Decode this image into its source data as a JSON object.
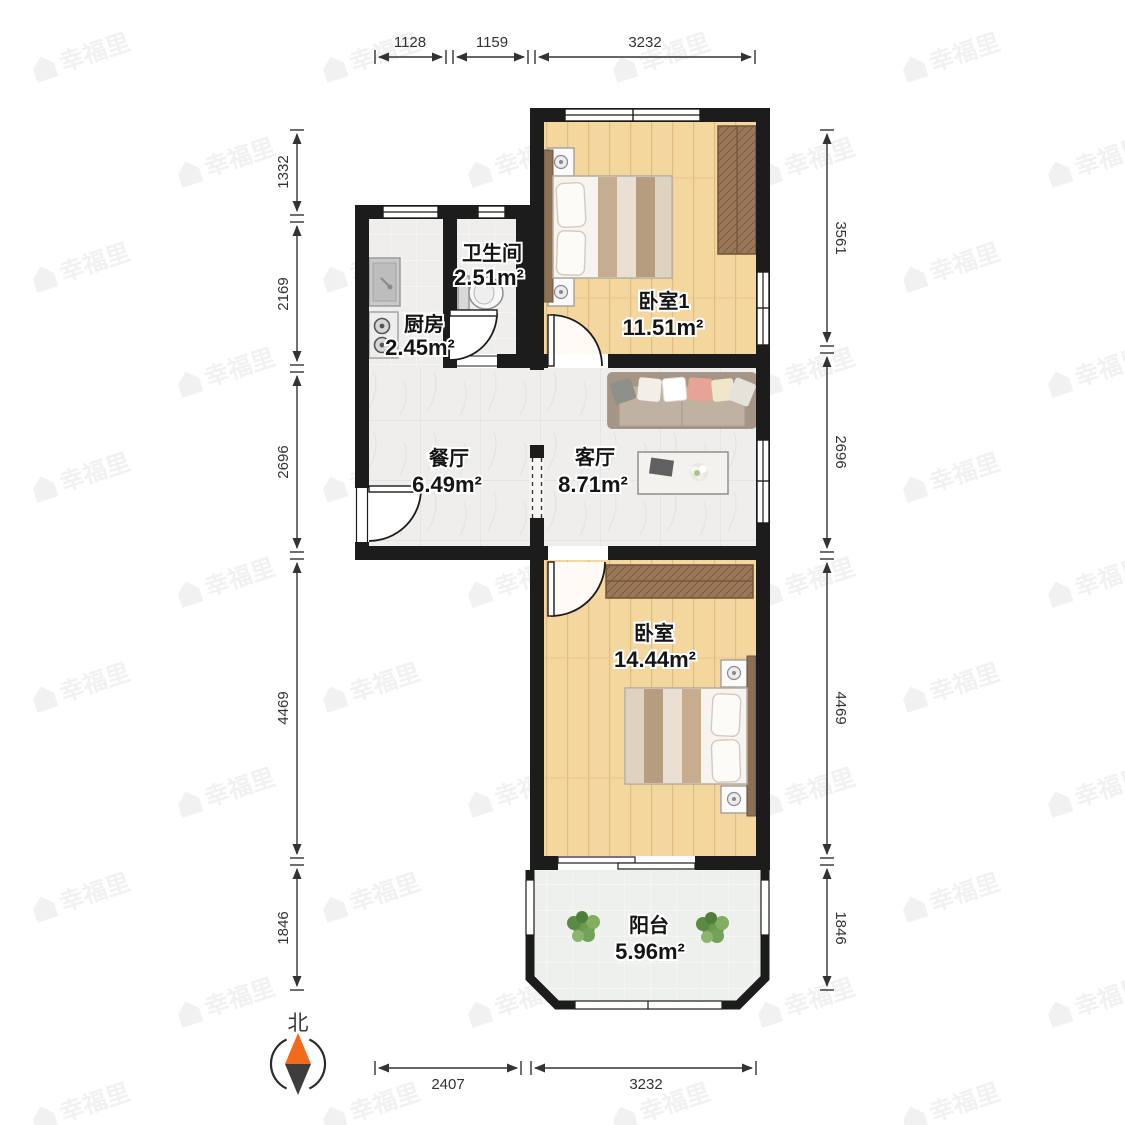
{
  "watermark": {
    "text": "幸福里"
  },
  "compass": {
    "label": "北"
  },
  "rooms": [
    {
      "name": "卫生间",
      "area": "2.51m²"
    },
    {
      "name": "厨房",
      "area": "2.45m²"
    },
    {
      "name": "卧室1",
      "area": "11.51m²"
    },
    {
      "name": "餐厅",
      "area": "6.49m²"
    },
    {
      "name": "客厅",
      "area": "8.71m²"
    },
    {
      "name": "卧室",
      "area": "14.44m²"
    },
    {
      "name": "阳台",
      "area": "5.96m²"
    }
  ],
  "dimensions": {
    "top": [
      "1128",
      "1159",
      "3232"
    ],
    "bottom": [
      "2407",
      "3232"
    ],
    "left": [
      "1332",
      "2169",
      "2696",
      "4469",
      "1846"
    ],
    "right": [
      "3561",
      "2696",
      "4469",
      "1846"
    ]
  },
  "colors": {
    "wall": "#1c1c1c",
    "wood_floor": "#f4d79f",
    "tile_floor": "#efeeec",
    "balcony_floor": "#edf0ec",
    "wardrobe": "#9a7758",
    "sofa": "#b7a899",
    "headboard": "#8b7054",
    "compass_north": "#f26a1c",
    "compass_south": "#3d3d3d",
    "dimension_text": "#333333",
    "watermark": "#f1f1f1"
  }
}
